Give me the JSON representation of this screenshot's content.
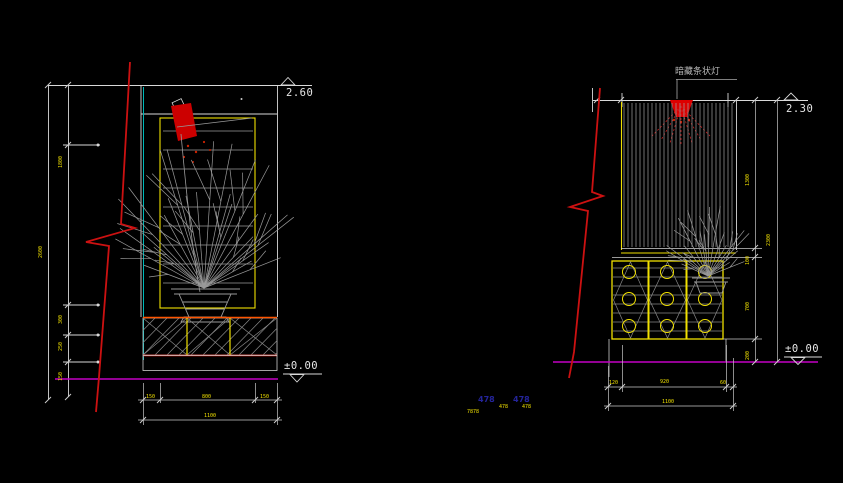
{
  "canvas": {
    "background": "#000000"
  },
  "colors": {
    "line_white": "#d9d9d9",
    "line_gray": "#999999",
    "yellow": "#f0e000",
    "red": "#cc1111",
    "orange_red": "#ff5500",
    "cyan": "#00b8b8",
    "magenta": "#c400c4",
    "blue_text": "#24249a"
  },
  "left_elevation": {
    "level_top": "2.60",
    "level_floor": "±0.00",
    "vdim_total": "2600",
    "vdims": [
      "1800",
      "300",
      "250",
      "150"
    ],
    "bottom_dims": [
      "150",
      "800",
      "150"
    ],
    "bottom_total": "1100"
  },
  "right_elevation": {
    "light_label": "暗藏条状灯",
    "level_top": "2.30",
    "level_floor": "±0.00",
    "vdim_total": "2300",
    "vdims": [
      "1300",
      "100",
      "700",
      "200"
    ],
    "bottom_dims": [
      "120",
      "920",
      "60"
    ],
    "bottom_total": "1100"
  },
  "footer": {
    "blue_labels": [
      "478",
      "478"
    ],
    "yellow_labels": [
      "7878",
      "478",
      "478"
    ]
  }
}
